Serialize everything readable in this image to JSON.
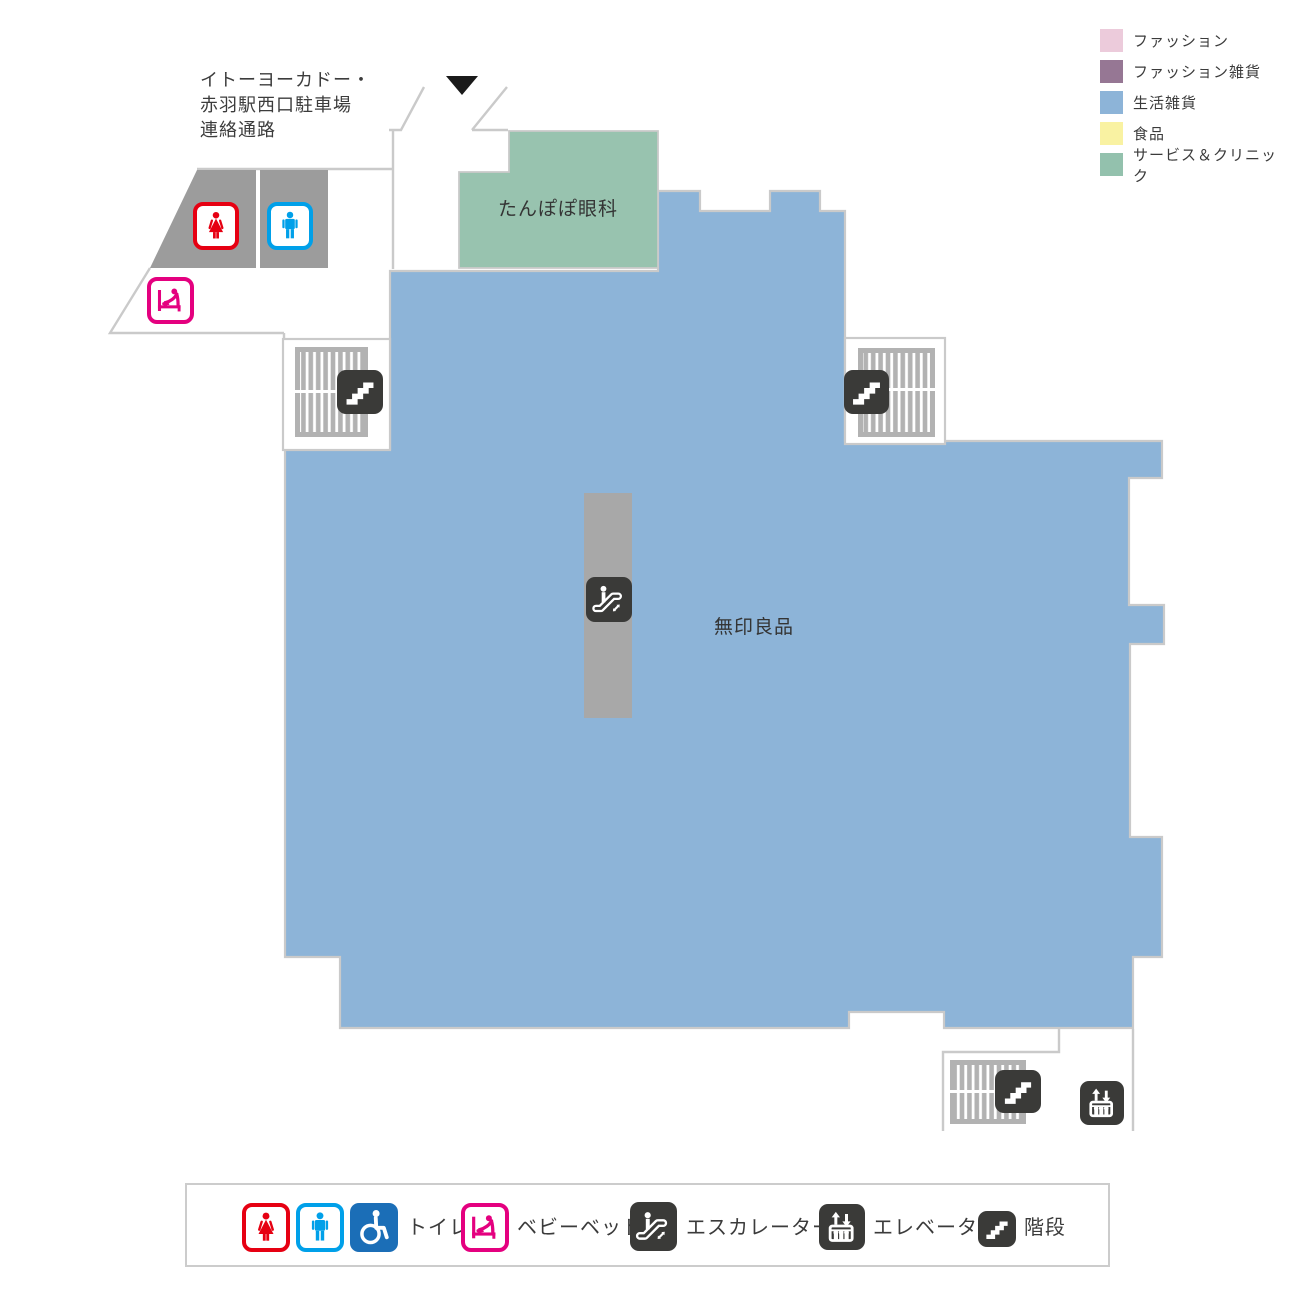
{
  "legend": {
    "items": [
      {
        "label": "ファッション",
        "color": "#eccbdb"
      },
      {
        "label": "ファッション雑貨",
        "color": "#967794"
      },
      {
        "label": "生活雑貨",
        "color": "#8db4d8"
      },
      {
        "label": "食品",
        "color": "#f9f2a2"
      },
      {
        "label": "サービス＆クリニック",
        "color": "#93c1ad"
      }
    ]
  },
  "map": {
    "entrance_label": {
      "line1": "イトーヨーカドー・",
      "line2": "赤羽駅西口駐車場",
      "line3": "連絡通路"
    },
    "stores": [
      {
        "name": "たんぽぽ眼科",
        "color": "#98c3af"
      },
      {
        "name": "無印良品",
        "color": "#8db4d8"
      }
    ],
    "floor_colors": {
      "outline": "#cacaca",
      "toilet_block": "#9c9c9c",
      "stair_hatch": "#b2b2b2",
      "escalator_strip": "#a8a8a8"
    }
  },
  "icons": {
    "women_color": "#e60012",
    "men_color": "#00a0e9",
    "wheelchair_bg": "#1b6eb7",
    "baby_color": "#e4007f",
    "facility_bg": "#3a3a38"
  },
  "facility_legend": {
    "toilet_label": "トイレ",
    "baby_bed_label": "ベビーベッド",
    "escalator_label": "エスカレーター",
    "elevator_label": "エレベーター",
    "stairs_label": "階段"
  }
}
